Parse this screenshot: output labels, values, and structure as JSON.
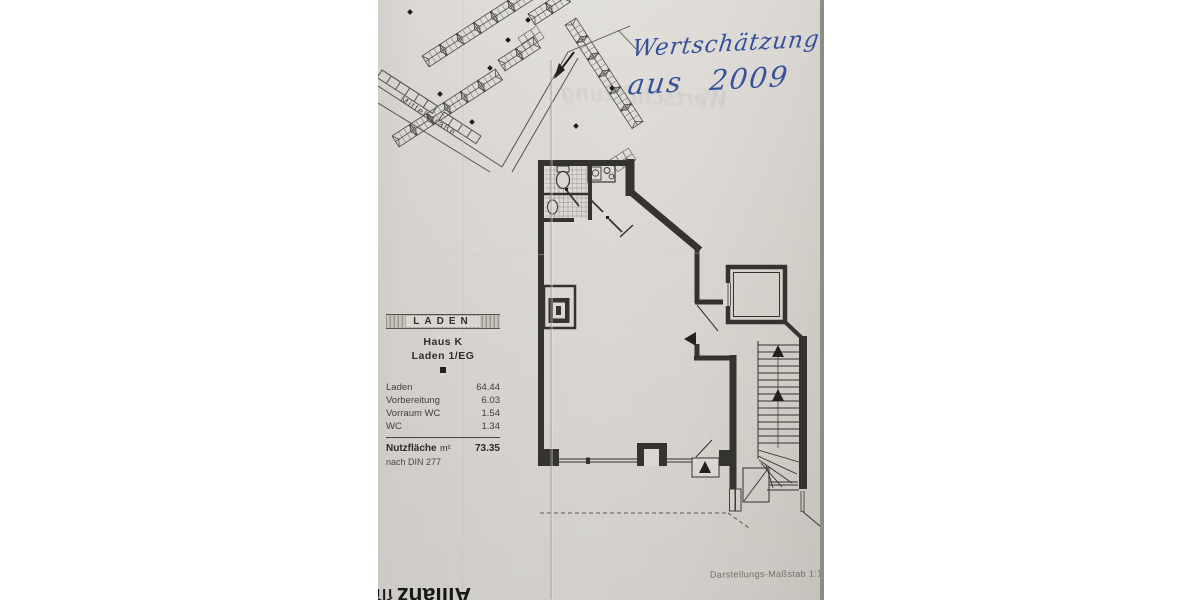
{
  "handwriting": {
    "line1": "Wertschätzung",
    "line2": "aus 2009"
  },
  "watermark": {
    "text": "Wertschätzung"
  },
  "site_plan": {
    "street_label": "Mittelstraße"
  },
  "legend": {
    "title": "LADEN",
    "subtitle1": "Haus K",
    "subtitle2": "Laden 1/EG",
    "rows": [
      {
        "label": "Laden",
        "value": "64.44"
      },
      {
        "label": "Vorbereitung",
        "value": "6.03"
      },
      {
        "label": "Vorraum WC",
        "value": "1.54"
      },
      {
        "label": "WC",
        "value": "1.34"
      }
    ],
    "total_label": "Nutzfläche",
    "total_unit": "m²",
    "total_value": "73.35",
    "total_note": "nach DIN 277"
  },
  "footer": {
    "scale_note": "Darstellungs-Maßstab 1:100"
  },
  "logo": {
    "brand": "Allianz"
  },
  "colors": {
    "paper": "#dad7d2",
    "drawing_ink": "#34332d",
    "handwriting_blue": "#36509c",
    "paper_edge": "#8e8d85"
  }
}
